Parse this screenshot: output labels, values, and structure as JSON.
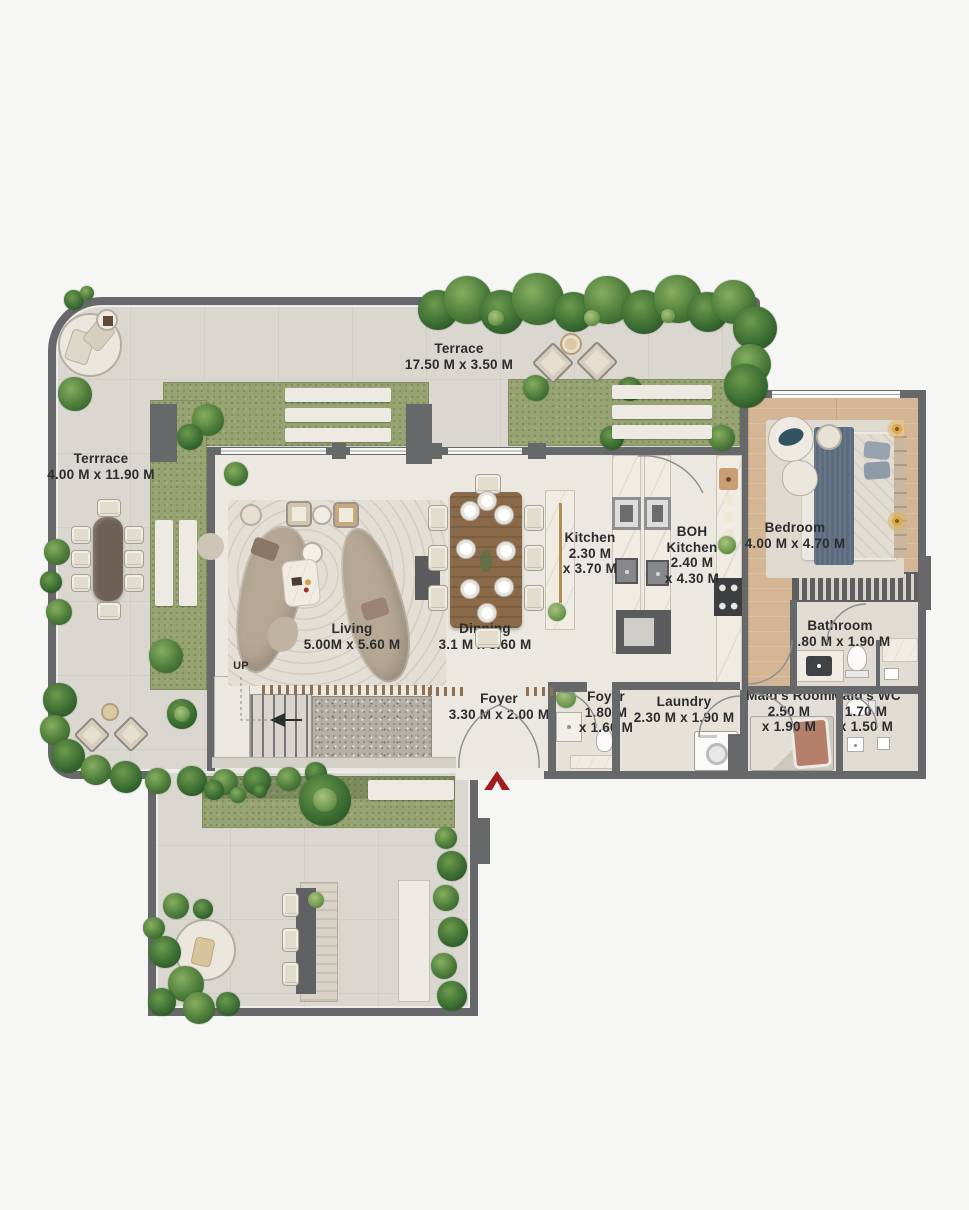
{
  "palette": {
    "page_bg": "#f6f6f5",
    "wall": "#67686a",
    "terrace": "#dad7d1",
    "interior": "#ebe8e2",
    "lawn": "#97a472",
    "lawn_dark": "#7e8b5f",
    "wood": "#d4b694",
    "marble": "#f0ebe3",
    "gravel": "#b4b0a7",
    "sofa": "#b6a895",
    "accent_red": "#a31c20",
    "bed_blanket": "#5c6c7e",
    "maid_pillow": "#b5806b"
  },
  "rooms": {
    "terrace_top": {
      "name": "Terrace",
      "dim": "17.50 M x 3.50 M"
    },
    "terrace_left": {
      "name": "Terrrace",
      "dim": "4.00 M x 11.90 M"
    },
    "living": {
      "name": "Living",
      "dim": "5.00M x 5.60 M"
    },
    "dinning": {
      "name": "Dinning",
      "dim": "3.1 M x 5.60 M"
    },
    "kitchen": {
      "name": "Kitchen",
      "dim1": "2.30 M",
      "dim2": "x 3.70 M"
    },
    "boh_kitchen": {
      "name1": "BOH",
      "name2": "Kitchen",
      "dim1": "2.40 M",
      "dim2": "x 4.30 M"
    },
    "bedroom": {
      "name": "Bedroom",
      "dim": "4.00 M x 4.70 M"
    },
    "bathroom": {
      "name": "Bathroom",
      "dim": "2.80 M x 1.90 M"
    },
    "foyer": {
      "name": "Foyer",
      "dim": "3.30 M x 2.00 M"
    },
    "foyer2": {
      "name": "Foyer",
      "dim1": "1.80 M",
      "dim2": "x 1.60 M"
    },
    "laundry": {
      "name": "Laundry",
      "dim": "2.30 M x 1.90 M"
    },
    "maids_room": {
      "name": "Maid’s Room",
      "dim1": "2.50 M",
      "dim2": "x 1.90 M"
    },
    "maids_wc": {
      "name": "Maid’s WC",
      "dim1": "1.70 M",
      "dim2": "x 1.50 M"
    }
  },
  "stairs": {
    "label": "UP"
  },
  "icons": {
    "entry_arrow": "chevron-up",
    "stair_direction": "arrow-left"
  }
}
